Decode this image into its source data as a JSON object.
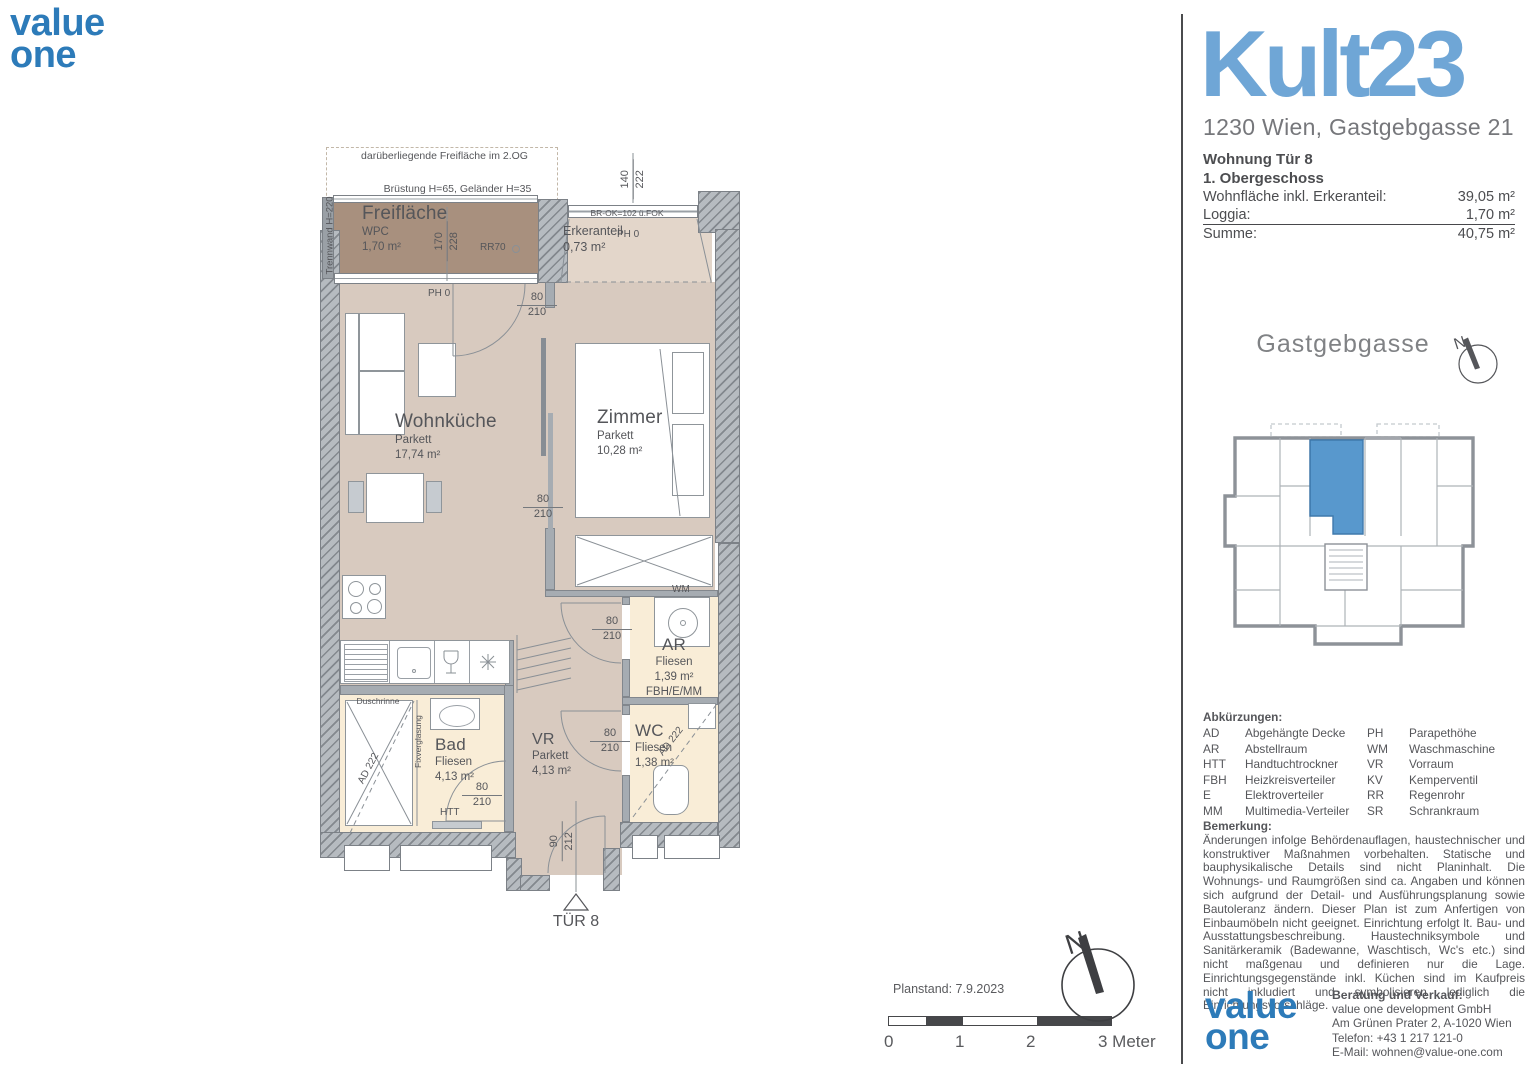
{
  "colors": {
    "accent_blue": "#2d7bb9",
    "project_blue": "#6fa6d6",
    "floor_parquet": "#d8cabf",
    "floor_tiles": "#f9edd7",
    "balcony_deck": "#a8907e",
    "wall_gray": "#b6bbc0",
    "unit_highlight": "#4a90c9"
  },
  "logo": {
    "word1": "value",
    "word2": "one"
  },
  "header": {
    "project": "Kult23",
    "address": "1230 Wien, Gastgebgasse 21",
    "unit": "Wohnung Tür 8",
    "floor": "1. Obergeschoss",
    "area_rows": [
      {
        "label": "Wohnfläche inkl. Erkeranteil:",
        "value": "39,05 m²"
      },
      {
        "label": "Loggia:",
        "value": "1,70 m²"
      },
      {
        "label": "Summe:",
        "value": "40,75 m²"
      }
    ]
  },
  "siteplan": {
    "street": "Gastgebgasse",
    "north": "N"
  },
  "abbreviations": {
    "title": "Abkürzungen:",
    "rows": [
      {
        "a": "AD",
        "at": "Abgehängte Decke",
        "b": "PH",
        "bt": "Parapethöhe"
      },
      {
        "a": "AR",
        "at": "Abstellraum",
        "b": "WM",
        "bt": "Waschmaschine"
      },
      {
        "a": "HTT",
        "at": "Handtuchtrockner",
        "b": "VR",
        "bt": "Vorraum"
      },
      {
        "a": "FBH",
        "at": "Heizkreisverteiler",
        "b": "KV",
        "bt": "Kemperventil"
      },
      {
        "a": "E",
        "at": "Elektroverteiler",
        "b": "RR",
        "bt": "Regenrohr"
      },
      {
        "a": "MM",
        "at": "Multimedia-Verteiler",
        "b": "SR",
        "bt": "Schrankraum"
      }
    ]
  },
  "remark": {
    "title": "Bemerkung:",
    "text": "Änderungen infolge Behördenauflagen, haustechnischer und konstruktiver Maßnahmen vorbehalten. Statische und bauphysikalische Details sind nicht Planinhalt. Die Wohnungs- und Raumgrößen sind ca. Angaben und können sich aufgrund der Detail- und Ausführungsplanung sowie Bautoleranz ändern. Dieser Plan ist zum Anfertigen von Einbaumöbeln nicht geeignet. Einrichtung erfolgt lt. Bau- und Ausstattungsbeschreibung. Haustechniksymbole und Sanitärkeramik (Badewanne, Waschtisch, Wc's etc.) sind nicht maßgenau und definieren nur die Lage. Einrichtungsgegenstände inkl. Küchen sind im Kaufpreis nicht inkludiert und symbolisieren lediglich die Einrichtungsvorschläge."
  },
  "contact": {
    "title": "Beratung und Verkauf:",
    "company": "value one development GmbH",
    "address": "Am Grünen Prater 2, A-1020 Wien",
    "phone": "Telefon: +43 1 217 121-0",
    "email": "E-Mail: wohnen@value-one.com"
  },
  "footer": {
    "planstand": "Planstand: 7.9.2023",
    "scale": [
      "0",
      "1",
      "2",
      "3 Meter"
    ]
  },
  "plan": {
    "rooms": {
      "freiflaeche": {
        "name": "Freifläche",
        "finish": "WPC",
        "area": "1,70 m²"
      },
      "erker": {
        "name": "Erkeranteil",
        "area": "0,73 m²"
      },
      "wohnkueche": {
        "name": "Wohnküche",
        "finish": "Parkett",
        "area": "17,74 m²"
      },
      "zimmer": {
        "name": "Zimmer",
        "finish": "Parkett",
        "area": "10,28 m²"
      },
      "ar": {
        "name": "AR",
        "finish": "Fliesen",
        "area": "1,39 m²",
        "extra": "FBH/E/MM"
      },
      "wc": {
        "name": "WC",
        "finish": "Fliesen",
        "area": "1,38 m²"
      },
      "bad": {
        "name": "Bad",
        "finish": "Fliesen",
        "area": "4,13 m²"
      },
      "vr": {
        "name": "VR",
        "finish": "Parkett",
        "area": "4,13 m²"
      }
    },
    "notes": {
      "above": "darüberliegende Freifläche im 2.OG",
      "bruestung": "Brüstung H=65, Geländer H=35",
      "trennwand": "Trennwand H=220",
      "br_ok": "BR-OK=102 ü.FOK",
      "rr": "RR70",
      "ph_balkon": "PH 0",
      "ph_erker": "PH 0",
      "wm": "WM",
      "htt": "HTT",
      "duschrinne": "Duschrinne",
      "fixverglasung": "Fixverglasung",
      "ad_bad": "AD 222",
      "ad_wc": "AD 222",
      "tuer": "TÜR 8"
    },
    "dims": {
      "balkontuer": {
        "w": "170",
        "h": "228"
      },
      "erkerfenster": {
        "w": "140",
        "h": "222"
      },
      "balkon_zugang": {
        "w": "80",
        "h": "210"
      },
      "zimmertuer": {
        "w": "80",
        "h": "210"
      },
      "ar_tuer": {
        "w": "80",
        "h": "210"
      },
      "wc_tuer": {
        "w": "80",
        "h": "210"
      },
      "bad_tuer": {
        "w": "80",
        "h": "210"
      },
      "eingang": {
        "w": "90",
        "h": "212"
      }
    }
  }
}
